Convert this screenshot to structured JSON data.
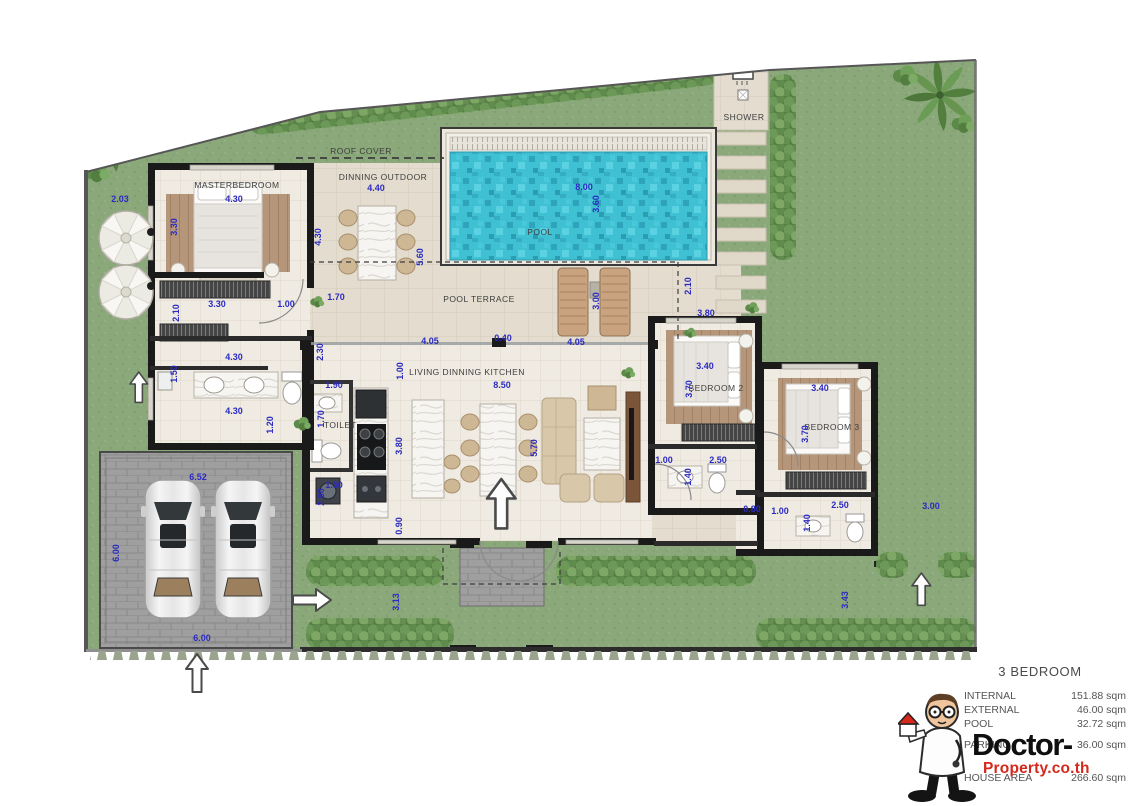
{
  "legend": {
    "title": "3 BEDROOM",
    "rows": [
      {
        "label": "INTERNAL",
        "value": "151.88 sqm"
      },
      {
        "label": "EXTERNAL",
        "value": "46.00 sqm"
      },
      {
        "label": "POOL",
        "value": "32.72 sqm"
      },
      {
        "label": "PARKING",
        "value": "36.00 sqm"
      },
      {
        "label": "HOUSE AREA",
        "value": "266.60 sqm"
      }
    ]
  },
  "branding": {
    "wordmark_top": "Doctor-",
    "wordmark_bottom": "Property.co.th",
    "accent_red": "#d5281c"
  },
  "colors": {
    "dimension_blue": "#2b2bc0",
    "label_grey": "#3d3d3d",
    "grass_green": "#8aa87a",
    "pool_water": "#3fc0d3"
  },
  "plan": {
    "room_labels": [
      {
        "text": "MASTERBEDROOM",
        "x": 237,
        "y": 185
      },
      {
        "text": "ROOF COVER",
        "x": 361,
        "y": 151
      },
      {
        "text": "DINNING OUTDOOR",
        "x": 383,
        "y": 177
      },
      {
        "text": "SHOWER",
        "x": 744,
        "y": 117
      },
      {
        "text": "POOL",
        "x": 540,
        "y": 232
      },
      {
        "text": "POOL TERRACE",
        "x": 479,
        "y": 299
      },
      {
        "text": "LIVING DINNING KITCHEN",
        "x": 467,
        "y": 372
      },
      {
        "text": "TOILET",
        "x": 340,
        "y": 425
      },
      {
        "text": "BEDROOM 2",
        "x": 716,
        "y": 388
      },
      {
        "text": "BEDROOM 3",
        "x": 832,
        "y": 427
      }
    ],
    "dimensions": [
      {
        "text": "2.03",
        "x": 120,
        "y": 199
      },
      {
        "text": "4.30",
        "x": 234,
        "y": 199
      },
      {
        "text": "3.30",
        "x": 174,
        "y": 227,
        "v": true
      },
      {
        "text": "4.30",
        "x": 318,
        "y": 237,
        "v": true
      },
      {
        "text": "4.40",
        "x": 376,
        "y": 188
      },
      {
        "text": "5.60",
        "x": 420,
        "y": 257,
        "v": true
      },
      {
        "text": "8.00",
        "x": 584,
        "y": 187
      },
      {
        "text": "3.60",
        "x": 596,
        "y": 204,
        "v": true
      },
      {
        "text": "1.70",
        "x": 336,
        "y": 297
      },
      {
        "text": "3.30",
        "x": 217,
        "y": 304
      },
      {
        "text": "1.00",
        "x": 286,
        "y": 304
      },
      {
        "text": "2.10",
        "x": 176,
        "y": 313,
        "v": true
      },
      {
        "text": "2.10",
        "x": 688,
        "y": 286,
        "v": true
      },
      {
        "text": "3.00",
        "x": 596,
        "y": 301,
        "v": true
      },
      {
        "text": "4.05",
        "x": 430,
        "y": 341
      },
      {
        "text": "0.40",
        "x": 503,
        "y": 338
      },
      {
        "text": "4.05",
        "x": 576,
        "y": 342
      },
      {
        "text": "3.80",
        "x": 706,
        "y": 313
      },
      {
        "text": "2.30",
        "x": 320,
        "y": 352,
        "v": true
      },
      {
        "text": "4.30",
        "x": 234,
        "y": 357
      },
      {
        "text": "1.50",
        "x": 174,
        "y": 374,
        "v": true
      },
      {
        "text": "1.90",
        "x": 334,
        "y": 385
      },
      {
        "text": "1.00",
        "x": 400,
        "y": 371,
        "v": true
      },
      {
        "text": "8.50",
        "x": 502,
        "y": 385
      },
      {
        "text": "4.30",
        "x": 234,
        "y": 411
      },
      {
        "text": "1.20",
        "x": 270,
        "y": 425,
        "v": true
      },
      {
        "text": "1.70",
        "x": 321,
        "y": 419,
        "v": true
      },
      {
        "text": "3.80",
        "x": 399,
        "y": 446,
        "v": true
      },
      {
        "text": "5.70",
        "x": 534,
        "y": 448,
        "v": true
      },
      {
        "text": "3.40",
        "x": 705,
        "y": 366
      },
      {
        "text": "3.70",
        "x": 689,
        "y": 389,
        "v": true
      },
      {
        "text": "3.40",
        "x": 820,
        "y": 388
      },
      {
        "text": "3.70",
        "x": 805,
        "y": 434,
        "v": true
      },
      {
        "text": "2.80",
        "x": 321,
        "y": 497,
        "v": true
      },
      {
        "text": "1.50",
        "x": 334,
        "y": 485
      },
      {
        "text": "0.90",
        "x": 399,
        "y": 526,
        "v": true
      },
      {
        "text": "1.00",
        "x": 664,
        "y": 460
      },
      {
        "text": "2.50",
        "x": 718,
        "y": 460
      },
      {
        "text": "1.40",
        "x": 688,
        "y": 477,
        "v": true
      },
      {
        "text": "0.80",
        "x": 752,
        "y": 509
      },
      {
        "text": "1.00",
        "x": 780,
        "y": 511
      },
      {
        "text": "2.50",
        "x": 840,
        "y": 505
      },
      {
        "text": "1.40",
        "x": 807,
        "y": 523,
        "v": true
      },
      {
        "text": "3.00",
        "x": 931,
        "y": 506
      },
      {
        "text": "6.52",
        "x": 198,
        "y": 477
      },
      {
        "text": "6.00",
        "x": 116,
        "y": 553,
        "v": true
      },
      {
        "text": "6.00",
        "x": 202,
        "y": 638
      },
      {
        "text": "3.13",
        "x": 396,
        "y": 602,
        "v": true
      },
      {
        "text": "3.43",
        "x": 845,
        "y": 600,
        "v": true
      }
    ]
  }
}
